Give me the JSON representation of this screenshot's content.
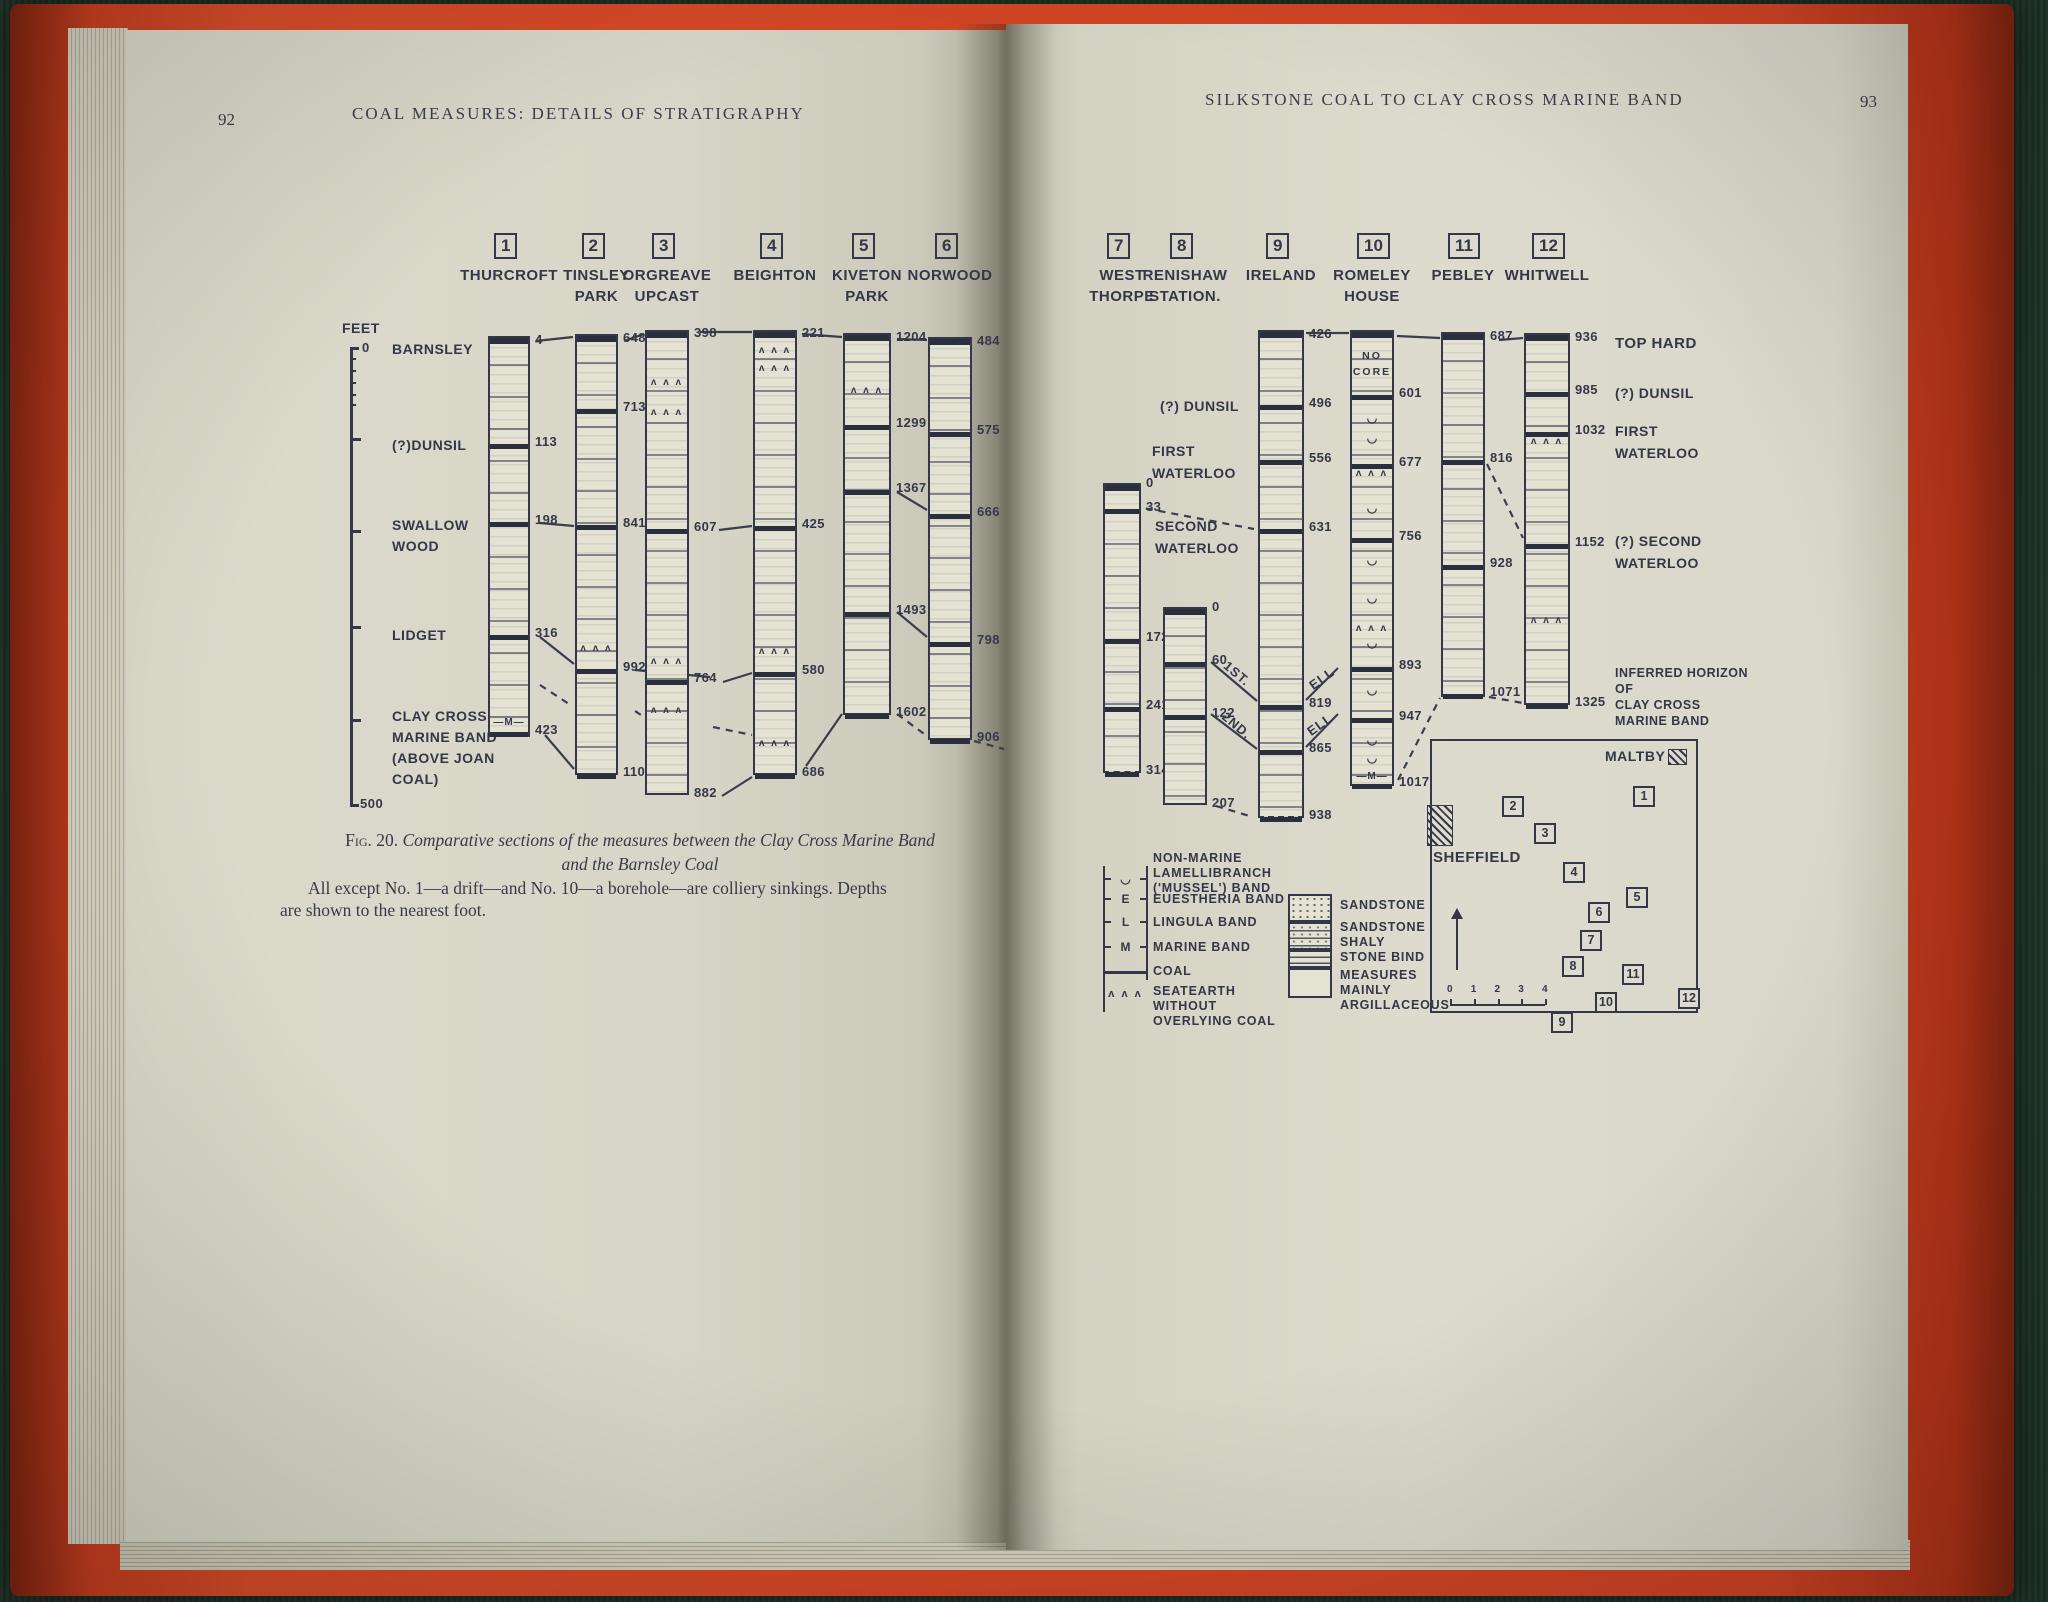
{
  "book": {
    "left_page_number": "92",
    "left_running_head": "COAL MEASURES: DETAILS OF STRATIGRAPHY",
    "right_running_head": "SILKSTONE COAL TO CLAY CROSS MARINE BAND",
    "right_page_number": "93"
  },
  "figure": {
    "caption": {
      "label": "Fig. 20.",
      "line1": "Comparative sections of the measures between the Clay Cross Marine Band",
      "line2": "and the Barnsley Coal",
      "line3": "All except No. 1—a drift—and No. 10—a borehole—are colliery sinkings. Depths",
      "line4": "are shown to the nearest foot."
    },
    "axis": {
      "feet_label": "FEET",
      "zero_label": "0",
      "bottom_label": "500",
      "x": 350,
      "top": 347,
      "bottom": 806,
      "minor_ticks": [
        358,
        370,
        382,
        394,
        404
      ],
      "major_ticks": [
        438,
        530,
        626,
        719
      ],
      "labels": [
        {
          "lines": [
            "BARNSLEY"
          ],
          "y": 341
        },
        {
          "lines": [
            "(?)DUNSIL"
          ],
          "y": 437
        },
        {
          "lines": [
            "SWALLOW",
            "WOOD"
          ],
          "y": 517
        },
        {
          "lines": [
            "LIDGET"
          ],
          "y": 627
        },
        {
          "lines": [
            "CLAY CROSS",
            "MARINE BAND",
            "(ABOVE JOAN",
            "COAL)"
          ],
          "y": 708
        }
      ]
    },
    "no_core_lines": [
      "NO",
      "CORE"
    ],
    "marine_symbol": "—M—",
    "seatearth_symbol": "ʌ ʌ ʌ",
    "mussel_symbol": "◡",
    "columns": [
      {
        "n": "1",
        "name": [
          "THURCROFT"
        ],
        "x": 488,
        "w": 42,
        "top": 336,
        "bot": 737,
        "m_mark": 724,
        "markers": [
          {
            "d": "4",
            "y": 340
          },
          {
            "d": "113",
            "y": 442
          },
          {
            "d": "198",
            "y": 520
          },
          {
            "d": "316",
            "y": 633
          },
          {
            "d": "423",
            "y": 730
          }
        ],
        "sym": []
      },
      {
        "n": "2",
        "name": [
          "TINSLEY",
          "PARK"
        ],
        "x": 575,
        "w": 43,
        "top": 334,
        "bot": 775,
        "markers": [
          {
            "d": "648",
            "y": 338
          },
          {
            "d": "713",
            "y": 407
          },
          {
            "d": "841",
            "y": 523
          },
          {
            "d": "992",
            "y": 667
          },
          {
            "d": "1102",
            "y": 772
          }
        ],
        "sym": [
          650
        ]
      },
      {
        "n": "3",
        "name": [
          "ORGREAVE",
          "UPCAST"
        ],
        "x": 645,
        "w": 44,
        "top": 330,
        "bot": 795,
        "markers": [
          {
            "d": "398",
            "y": 333
          },
          {
            "d": "607",
            "y": 527
          },
          {
            "d": "764",
            "y": 678
          },
          {
            "d": "882",
            "y": 793
          }
        ],
        "sym": [
          384,
          414,
          663,
          712
        ]
      },
      {
        "n": "4",
        "name": [
          "BEIGHTON"
        ],
        "x": 753,
        "w": 44,
        "top": 330,
        "bot": 775,
        "markers": [
          {
            "d": "221",
            "y": 333
          },
          {
            "d": "425",
            "y": 524
          },
          {
            "d": "580",
            "y": 670
          },
          {
            "d": "686",
            "y": 772
          }
        ],
        "sym": [
          352,
          370,
          653,
          745
        ]
      },
      {
        "n": "5",
        "name": [
          "KIVETON",
          "PARK"
        ],
        "x": 843,
        "w": 48,
        "top": 333,
        "bot": 715,
        "markers": [
          {
            "d": "1204",
            "y": 337
          },
          {
            "d": "1299",
            "y": 423
          },
          {
            "d": "1367",
            "y": 488
          },
          {
            "d": "1493",
            "y": 610
          },
          {
            "d": "1602",
            "y": 712
          }
        ],
        "sym": [
          392
        ]
      },
      {
        "n": "6",
        "name": [
          "NORWOOD"
        ],
        "x": 928,
        "w": 44,
        "top": 337,
        "bot": 740,
        "markers": [
          {
            "d": "484",
            "y": 341
          },
          {
            "d": "575",
            "y": 430
          },
          {
            "d": "666",
            "y": 512
          },
          {
            "d": "798",
            "y": 640
          },
          {
            "d": "906",
            "y": 737
          }
        ],
        "sym": []
      },
      {
        "n": "7",
        "name": [
          "WEST",
          "THORPE"
        ],
        "x": 1103,
        "w": 38,
        "top": 483,
        "bot": 773,
        "dashed": true,
        "markers": [
          {
            "d": "0",
            "y": 483
          },
          {
            "d": "33",
            "y": 507
          },
          {
            "d": "172",
            "y": 637
          },
          {
            "d": "241",
            "y": 705
          },
          {
            "d": "314",
            "y": 770
          }
        ],
        "sym": []
      },
      {
        "n": "8",
        "name": [
          "RENISHAW",
          "STATION."
        ],
        "x": 1163,
        "w": 44,
        "top": 607,
        "bot": 805,
        "markers": [
          {
            "d": "0",
            "y": 607
          },
          {
            "d": "60",
            "y": 660
          },
          {
            "d": "122",
            "y": 713
          },
          {
            "d": "207",
            "y": 803
          }
        ],
        "sym": []
      },
      {
        "n": "9",
        "name": [
          "IRELAND"
        ],
        "x": 1258,
        "w": 46,
        "top": 330,
        "bot": 818,
        "dashed": true,
        "markers": [
          {
            "d": "426",
            "y": 334
          },
          {
            "d": "496",
            "y": 403
          },
          {
            "d": "556",
            "y": 458
          },
          {
            "d": "631",
            "y": 527
          },
          {
            "d": "819",
            "y": 703
          },
          {
            "d": "865",
            "y": 748
          },
          {
            "d": "938",
            "y": 815
          }
        ],
        "sym": []
      },
      {
        "n": "10",
        "name": [
          "ROMELEY",
          "HOUSE"
        ],
        "x": 1350,
        "w": 44,
        "top": 330,
        "bot": 786,
        "no_core": true,
        "m_mark": 778,
        "markers": [
          {
            "d": "601",
            "y": 393
          },
          {
            "d": "677",
            "y": 462
          },
          {
            "d": "756",
            "y": 536
          },
          {
            "d": "893",
            "y": 665
          },
          {
            "d": "947",
            "y": 716
          },
          {
            "d": "1017",
            "y": 782
          }
        ],
        "sym": [
          475,
          630
        ],
        "mus": [
          420,
          440,
          510,
          562,
          600,
          645,
          692,
          742,
          760
        ]
      },
      {
        "n": "11",
        "name": [
          "PEBLEY"
        ],
        "x": 1441,
        "w": 44,
        "top": 332,
        "bot": 697,
        "dashed": true,
        "markers": [
          {
            "d": "687",
            "y": 336
          },
          {
            "d": "816",
            "y": 458
          },
          {
            "d": "928",
            "y": 563
          },
          {
            "d": "1071",
            "y": 692
          }
        ],
        "sym": []
      },
      {
        "n": "12",
        "name": [
          "WHITWELL"
        ],
        "x": 1524,
        "w": 46,
        "top": 333,
        "bot": 705,
        "markers": [
          {
            "d": "936",
            "y": 337
          },
          {
            "d": "985",
            "y": 390
          },
          {
            "d": "1032",
            "y": 430
          },
          {
            "d": "1152",
            "y": 542
          },
          {
            "d": "1325",
            "y": 702
          }
        ],
        "sym": [
          443,
          622
        ]
      }
    ],
    "mid_labels": [
      {
        "lines": [
          "(?) DUNSIL"
        ],
        "x": 1160,
        "y": 398
      },
      {
        "lines": [
          "FIRST",
          "WATERLOO"
        ],
        "x": 1152,
        "y": 443
      },
      {
        "lines": [
          "SECOND",
          "WATERLOO"
        ],
        "x": 1155,
        "y": 518
      }
    ],
    "right_labels": [
      {
        "lines": [
          "TOP HARD"
        ],
        "x": 1615,
        "y": 335,
        "size": 15
      },
      {
        "lines": [
          "(?) DUNSIL"
        ],
        "x": 1615,
        "y": 385,
        "size": 14
      },
      {
        "lines": [
          "FIRST",
          "WATERLOO"
        ],
        "x": 1615,
        "y": 423,
        "size": 14
      },
      {
        "lines": [
          "(?) SECOND",
          "WATERLOO"
        ],
        "x": 1615,
        "y": 533,
        "size": 14
      },
      {
        "lines": [
          "INFERRED HORIZON",
          "OF",
          "CLAY CROSS",
          "MARINE BAND"
        ],
        "x": 1615,
        "y": 666,
        "size": 12.5
      }
    ],
    "rot_labels": [
      {
        "t": "1ST.",
        "x": 1222,
        "y": 666,
        "r": 40
      },
      {
        "t": "2ND.",
        "x": 1220,
        "y": 718,
        "r": 40
      },
      {
        "t": "ELL",
        "x": 1308,
        "y": 671,
        "r": -36
      },
      {
        "t": "ELL",
        "x": 1306,
        "y": 717,
        "r": -36
      }
    ],
    "links": [
      [
        536,
        341,
        573,
        337,
        0
      ],
      [
        624,
        341,
        644,
        334,
        0
      ],
      [
        700,
        332,
        752,
        332,
        0
      ],
      [
        802,
        334,
        842,
        337,
        0
      ],
      [
        897,
        339,
        927,
        340,
        0
      ],
      [
        540,
        523,
        574,
        526,
        0
      ],
      [
        719,
        530,
        752,
        526,
        0
      ],
      [
        540,
        637,
        574,
        664,
        0
      ],
      [
        545,
        735,
        574,
        769,
        0
      ],
      [
        635,
        670,
        710,
        677,
        0
      ],
      [
        723,
        682,
        752,
        673,
        0
      ],
      [
        722,
        796,
        752,
        777,
        0
      ],
      [
        806,
        766,
        842,
        714,
        0
      ],
      [
        897,
        492,
        927,
        510,
        0
      ],
      [
        897,
        612,
        927,
        637,
        0
      ],
      [
        540,
        685,
        572,
        706,
        1
      ],
      [
        635,
        711,
        644,
        717,
        1
      ],
      [
        713,
        727,
        752,
        735,
        1
      ],
      [
        897,
        714,
        927,
        736,
        1
      ],
      [
        974,
        741,
        1004,
        749,
        1
      ],
      [
        1306,
        333,
        1349,
        333,
        0
      ],
      [
        1397,
        336,
        1440,
        338,
        0
      ],
      [
        1499,
        340,
        1523,
        338,
        0
      ],
      [
        1133,
        506,
        1254,
        529,
        1
      ],
      [
        1211,
        662,
        1257,
        701,
        0
      ],
      [
        1211,
        714,
        1257,
        749,
        0
      ],
      [
        1338,
        668,
        1306,
        700,
        0
      ],
      [
        1338,
        714,
        1306,
        747,
        0
      ],
      [
        1216,
        806,
        1253,
        817,
        1
      ],
      [
        1398,
        780,
        1440,
        698,
        1
      ],
      [
        1487,
        464,
        1523,
        538,
        1
      ],
      [
        1489,
        697,
        1523,
        703,
        1
      ]
    ],
    "legend_left": {
      "bracket": {
        "x1": 1103,
        "x2": 1146,
        "top": 866,
        "bot": 1012
      },
      "items": [
        {
          "sym": "◡",
          "sy": 872,
          "lines": [
            "NON-MARINE",
            "LAMELLIBRANCH",
            "('MUSSEL') BAND"
          ],
          "ty": 851
        },
        {
          "sym": "E",
          "sy": 892,
          "lines": [
            "EUESTHERIA BAND"
          ],
          "ty": 892
        },
        {
          "sym": "L",
          "sy": 915,
          "lines": [
            "LINGULA BAND"
          ],
          "ty": 915
        },
        {
          "sym": "M",
          "sy": 940,
          "lines": [
            "MARINE BAND"
          ],
          "ty": 940
        },
        {
          "sym": "coal",
          "sy": 971,
          "lines": [
            "COAL"
          ],
          "ty": 964
        },
        {
          "sym": "seat",
          "sy": 988,
          "lines": [
            "SEATEARTH",
            "WITHOUT",
            "OVERLYING COAL"
          ],
          "ty": 984
        }
      ],
      "text_x": 1153
    },
    "legend_right": {
      "swatch_x": 1288,
      "swatch_w": 44,
      "items": [
        {
          "pat": "pat-dots",
          "y": 894,
          "h": 28,
          "lines": [
            "SANDSTONE"
          ],
          "ty": 898
        },
        {
          "pat": "pat-dotdash",
          "y": 922,
          "h": 28,
          "lines": [
            "SANDSTONE",
            "SHALY"
          ],
          "ty": 920
        },
        {
          "pat": "pat-dash",
          "y": 950,
          "h": 18,
          "lines": [
            "STONE BIND"
          ],
          "ty": 950
        },
        {
          "pat": "",
          "y": 968,
          "h": 30,
          "lines": [
            "MEASURES",
            "MAINLY",
            "ARGILLACEOUS"
          ],
          "ty": 968
        }
      ],
      "text_x": 1340
    },
    "map": {
      "frame": {
        "x": 1430,
        "y": 739,
        "w": 268,
        "h": 274
      },
      "maltby_label": "MALTBY",
      "maltby_pos": {
        "x": 1605,
        "y": 748
      },
      "maltby_hatch": {
        "x": 1668,
        "y": 749,
        "w": 19,
        "h": 16
      },
      "sheffield_label": "SHEFFIELD",
      "sheffield_pos": {
        "x": 1433,
        "y": 849
      },
      "sheffield_hatch": {
        "x": 1427,
        "y": 805,
        "w": 26,
        "h": 41
      },
      "sites": [
        {
          "n": "1",
          "x": 1633,
          "y": 786
        },
        {
          "n": "2",
          "x": 1502,
          "y": 796
        },
        {
          "n": "3",
          "x": 1534,
          "y": 823
        },
        {
          "n": "4",
          "x": 1563,
          "y": 862
        },
        {
          "n": "5",
          "x": 1626,
          "y": 887
        },
        {
          "n": "6",
          "x": 1588,
          "y": 902
        },
        {
          "n": "7",
          "x": 1580,
          "y": 930
        },
        {
          "n": "8",
          "x": 1562,
          "y": 956
        },
        {
          "n": "11",
          "x": 1622,
          "y": 964
        },
        {
          "n": "10",
          "x": 1595,
          "y": 992
        },
        {
          "n": "12",
          "x": 1678,
          "y": 988
        },
        {
          "n": "9",
          "x": 1551,
          "y": 1012
        }
      ],
      "north_arrow": {
        "x": 1456,
        "y1": 918,
        "y2": 970
      },
      "scale": {
        "x": 1450,
        "y": 1004,
        "w": 95,
        "ticks": [
          "0",
          "1",
          "2",
          "3",
          "4"
        ]
      }
    }
  }
}
